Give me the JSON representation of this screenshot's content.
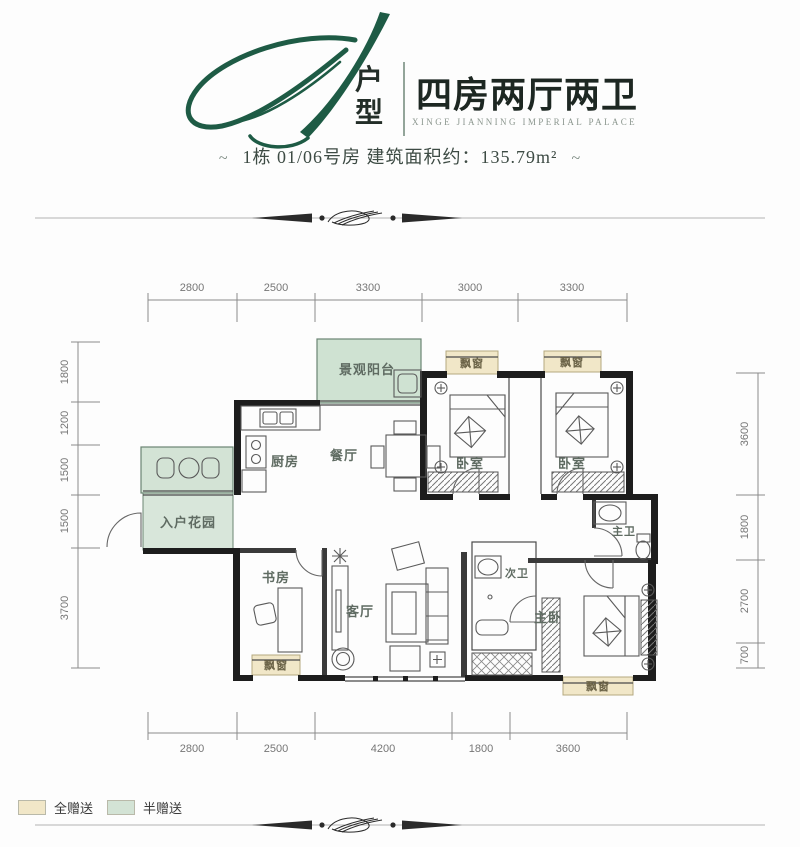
{
  "header": {
    "plan_letter": "A",
    "plan_type": "户型",
    "plan_type_chars": [
      "户",
      "型"
    ],
    "title": "四房两厅两卫",
    "subtitle_en": "XINGE JIANNING IMPERIAL PALACE",
    "dash": "~",
    "building_info": "1栋 01/06号房  建筑面积约：135.79m²"
  },
  "floorplan": {
    "rooms": [
      {
        "name": "balcony",
        "label": "景观阳台"
      },
      {
        "name": "kitchen",
        "label": "厨房"
      },
      {
        "name": "dining",
        "label": "餐厅"
      },
      {
        "name": "bedroom-1",
        "label": "卧室"
      },
      {
        "name": "bedroom-2",
        "label": "卧室"
      },
      {
        "name": "entry-garden",
        "label": "入户花园"
      },
      {
        "name": "study",
        "label": "书房"
      },
      {
        "name": "living",
        "label": "客厅"
      },
      {
        "name": "second-bath",
        "label": "次卫"
      },
      {
        "name": "master-bath",
        "label": "主卫"
      },
      {
        "name": "master-bedroom",
        "label": "主卧"
      }
    ],
    "bay_window_label": "飘窗",
    "dimensions": {
      "top": [
        "2800",
        "2500",
        "3300",
        "3000",
        "3300"
      ],
      "bottom": [
        "2800",
        "2500",
        "4200",
        "1800",
        "3600"
      ],
      "left": [
        "1800",
        "1200",
        "1500",
        "1500",
        "3700"
      ],
      "right": [
        "3600",
        "1800",
        "2700",
        "700"
      ]
    }
  },
  "legend": {
    "items": [
      {
        "label": "全赠送",
        "color": "#f1e7c8"
      },
      {
        "label": "半赠送",
        "color": "#d3e3d5"
      }
    ]
  },
  "colors": {
    "brand_green": "#1e5b45",
    "title_text": "#1d2722",
    "wall": "#1d1d1d",
    "green_fill": "#d3e3d5",
    "beige_fill": "#f1e7c8",
    "dimension_text": "#767676"
  }
}
